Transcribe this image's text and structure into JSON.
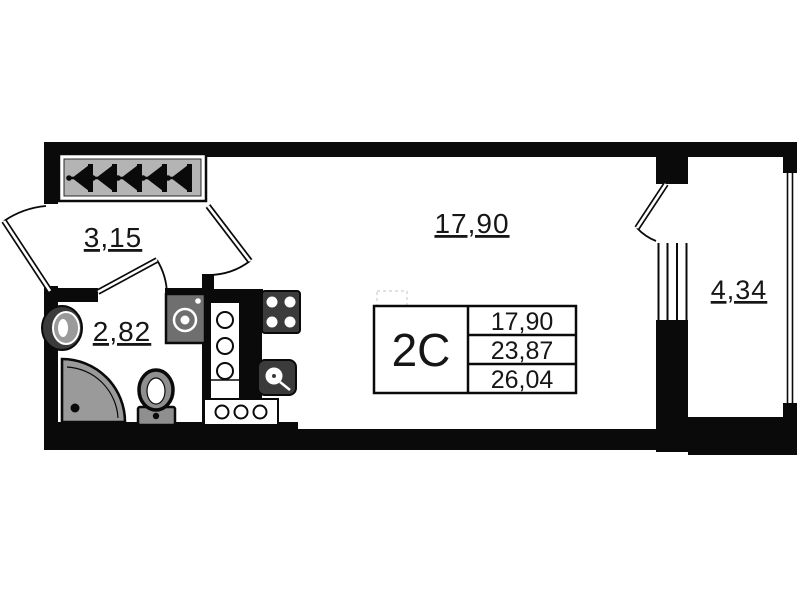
{
  "info_box": {
    "unit_type": "2C",
    "area_rows": [
      "17,90",
      "23,87",
      "26,04"
    ]
  },
  "rooms": {
    "hallway": {
      "area_label": "3,15"
    },
    "bathroom": {
      "area_label": "2,82"
    },
    "living_room": {
      "area_label": "17,90"
    },
    "balcony": {
      "area_label": "4,34"
    }
  },
  "symbols": {
    "wardrobe": "hanger-icon",
    "hanger_count": 5,
    "bathroom_fixtures": [
      "washbasin",
      "corner-shower",
      "toilet",
      "washing-machine"
    ],
    "kitchen_fixtures": [
      "stove-4-burner",
      "kitchen-sink",
      "vent-shaft-vertical",
      "vent-shaft-horizontal"
    ],
    "doors": [
      "entrance-door",
      "bathroom-door",
      "living-room-door",
      "balcony-door"
    ],
    "windows": [
      "balcony-window",
      "balcony-glazing"
    ]
  },
  "colors": {
    "wall": "#0a0a0a",
    "fixture-dark": "#3b3b3b",
    "fixture-grey": "#9a9a9a",
    "wardrobe-fill": "#b4b4b4",
    "background": "#ffffff"
  }
}
